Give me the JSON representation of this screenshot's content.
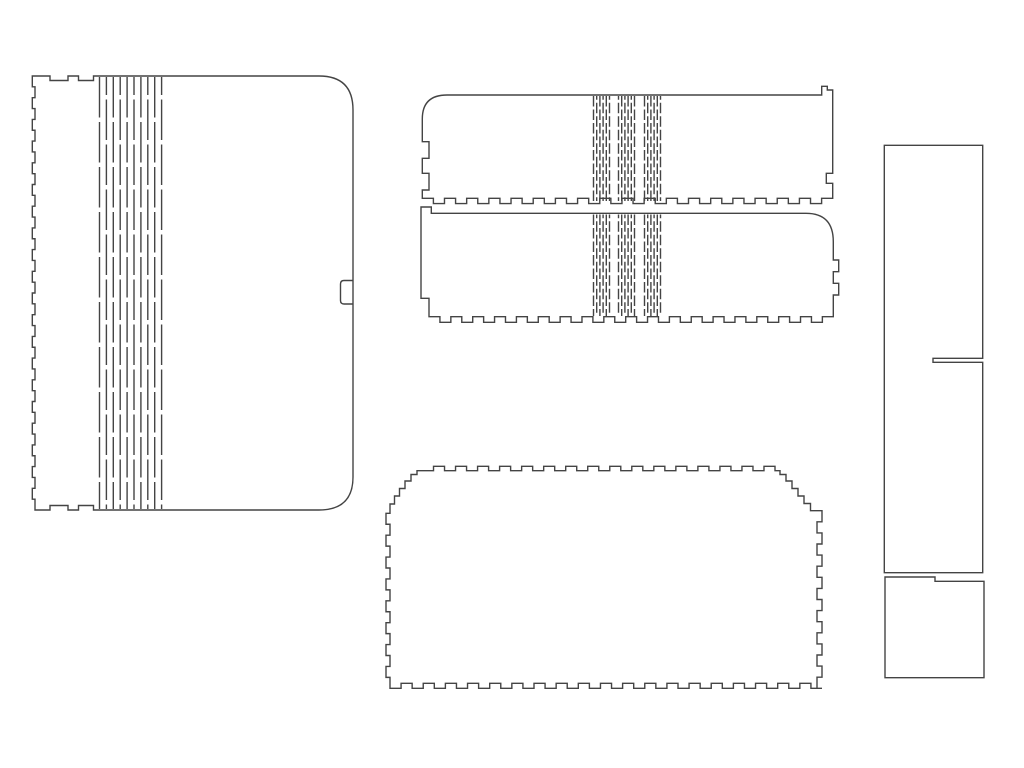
{
  "document": {
    "type": "laser-cut-panel-layout",
    "background_color": "#ffffff"
  },
  "canvas": {
    "width": 1024,
    "height": 768
  },
  "style": {
    "stroke_color": "#444444",
    "stroke_width": 1.4
  },
  "panels": [
    {
      "name": "wrap-panel-large",
      "role": "large rounded side panel with living hinge, finger-joint left edge and edge slot",
      "paths": [
        [
          "M",
          35,
          76,
          "H",
          50,
          "V",
          80.5,
          "H",
          68,
          "V",
          76,
          "H",
          78.5,
          "V",
          80.5,
          "H",
          93.5,
          "V",
          76,
          "H",
          319,
          "Q",
          353,
          76,
          353,
          110,
          "V",
          477,
          "Q",
          353,
          510,
          319,
          510,
          "H",
          93.5,
          "V",
          505.5,
          "H",
          78.5,
          "V",
          510,
          "H",
          68,
          "V",
          505.5,
          "H",
          50,
          "V",
          510,
          "H",
          35,
          "T",
          35,
          76,
          -2.7,
          10.85,
          "Z"
        ],
        [
          "M",
          352.5,
          280.5,
          "H",
          344,
          "Q",
          340.5,
          280.5,
          340.5,
          284,
          "V",
          300.5,
          "Q",
          340.5,
          304,
          344,
          304,
          "H",
          352.5
        ]
      ],
      "hinges": [
        {
          "groups": [
            99.5
          ],
          "dx": 6.9,
          "count": 10,
          "y0": 77,
          "y1": 509,
          "dash": 40.5,
          "gap": 4.5
        }
      ]
    },
    {
      "name": "strip-panel-top",
      "role": "upper narrow band with triple living-hinge groups, hook at right, finger-joint bottom edge",
      "paths": [
        [
          "M",
          422.3,
          119,
          "Q",
          422.3,
          95,
          447,
          95,
          "H",
          821.7,
          "V",
          86.3,
          "H",
          827.3,
          "V",
          90,
          "H",
          832.7,
          "V",
          173.3,
          "H",
          826.3,
          "V",
          183.3,
          "H",
          832.7,
          "V",
          198.3,
          "T",
          422.3,
          198.3,
          5.3,
          11,
          "V",
          190,
          "H",
          429,
          "V",
          173.3,
          "H",
          422.3,
          "V",
          158.3,
          "H",
          429,
          "V",
          141.7,
          "H",
          422.3,
          "Z"
        ]
      ],
      "hinges": [
        {
          "groups": [
            593.5,
            618.5,
            644.5
          ],
          "dx": 3.2,
          "count": 6,
          "y0": 96,
          "y1": 201,
          "dash": 10.5,
          "gap": 3
        }
      ]
    },
    {
      "name": "strip-panel-middle",
      "role": "lower narrow band with triple living-hinge groups, rounded right corner, tabs on right edge",
      "paths": [
        [
          "M",
          421,
          207,
          "H",
          431.3,
          "V",
          213.3,
          "H",
          806,
          "Q",
          833.3,
          213.3,
          833.3,
          241.7,
          "V",
          260,
          "H",
          838.7,
          "V",
          271.7,
          "H",
          833.3,
          "V",
          283.3,
          "H",
          838.7,
          "V",
          295,
          "H",
          833.3,
          "V",
          316.7,
          "T",
          429,
          316.7,
          5.6,
          11,
          "V",
          298.3,
          "H",
          421,
          "Z"
        ]
      ],
      "hinges": [
        {
          "groups": [
            593.5,
            618.5,
            644.5
          ],
          "dx": 3.2,
          "count": 6,
          "y0": 214.5,
          "y1": 316,
          "dash": 10.5,
          "gap": 3
        }
      ]
    },
    {
      "name": "bottom-panel",
      "role": "base plate with finger joints on all edges and stepped top corners",
      "paths": [
        [
          "M",
          390,
          513.3,
          "V",
          504,
          "H",
          394.5,
          "V",
          496,
          "H",
          399.5,
          "V",
          488.5,
          "H",
          405,
          "V",
          481,
          "H",
          411,
          "V",
          474.5,
          "H",
          417,
          "V",
          470.7,
          "H",
          422.5,
          "T",
          775,
          470.7,
          -4.4,
          11,
          "H",
          780,
          "V",
          474.5,
          "H",
          786,
          "V",
          481,
          "H",
          792,
          "V",
          488.5,
          "H",
          798,
          "V",
          496,
          "H",
          804,
          "V",
          503.5,
          "H",
          810.5,
          "V",
          510.7,
          "H",
          822,
          "T",
          822,
          688.3,
          -5,
          11,
          "T",
          390,
          688.3,
          -5,
          11,
          "T",
          390,
          513.3,
          -4,
          11,
          "Z"
        ]
      ],
      "hinges": []
    },
    {
      "name": "divider-panel-tall",
      "role": "tall rectangular divider with horizontal slot open at right edge",
      "paths": [
        [
          "M",
          884.3,
          145.3,
          "H",
          982.7,
          "V",
          358.3,
          "H",
          933,
          "V",
          362.3,
          "H",
          982.7,
          "V",
          572.7,
          "H",
          884.3,
          "Z"
        ]
      ],
      "hinges": []
    },
    {
      "name": "small-square-panel",
      "role": "small plate with stepped top-right edge",
      "paths": [
        [
          "M",
          885,
          577,
          "H",
          935,
          "V",
          581.3,
          "H",
          984,
          "V",
          677.7,
          "H",
          885,
          "Z"
        ]
      ],
      "hinges": []
    }
  ]
}
